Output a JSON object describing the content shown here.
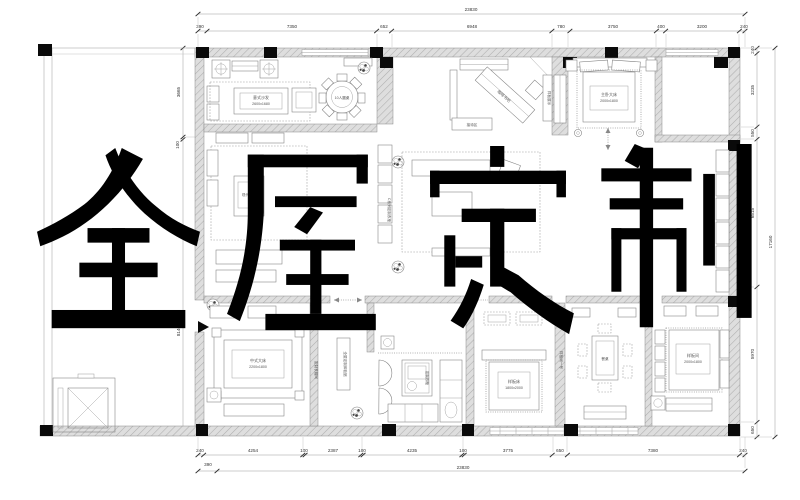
{
  "overlay": {
    "title": "全屋定制",
    "color": "#000000"
  },
  "dimensions": {
    "top_total": "23830",
    "top": [
      "390",
      "7350",
      "652",
      "6948",
      "780",
      "3750",
      "400",
      "3200",
      "240"
    ],
    "bottom": [
      "240",
      "4254",
      "100",
      "2387",
      "100",
      "4235",
      "100",
      "3775",
      "650",
      "7380",
      "240"
    ],
    "bottom_sub": "390",
    "bottom_total": "23830",
    "right": [
      "240",
      "3235",
      "550",
      "6515",
      "5970",
      "650"
    ],
    "right_total": "17160",
    "left": [
      "3665",
      "100",
      "8140"
    ]
  },
  "rooms": {
    "sofa_display": {
      "label": "意式沙发",
      "size": "2600x1680"
    },
    "round_dining": {
      "label": "10人圆桌"
    },
    "cafe": {
      "label": "咖啡书吧"
    },
    "cafe_side": {
      "label": "接待区"
    },
    "sample_strip": {
      "label": "样板展示"
    },
    "master_bedroom": {
      "label": "主卧大床",
      "size": "2000x1800"
    },
    "modern_living": {
      "label": "现代客厅"
    },
    "wardrobe_wall": {
      "label": "C系列定制衣柜"
    },
    "experience_hall": {
      "label": "全屋定制体验馆"
    },
    "closet_strip": {
      "label": "定制衣帽间"
    },
    "canopy_bed": {
      "label": "中式大床",
      "size": "2200x1800"
    },
    "kitchen_island": {
      "label": "定制橱柜"
    },
    "guest_bed": {
      "label": "样板床",
      "size": "1800x2000"
    },
    "sample_room_1": {
      "label": "样板间一号"
    },
    "dining_table": {
      "label": "餐桌"
    },
    "sample_room_2": {
      "label": "样板间",
      "size": "2000x1800"
    },
    "tv_cabinet": {
      "label": "电视柜"
    }
  }
}
